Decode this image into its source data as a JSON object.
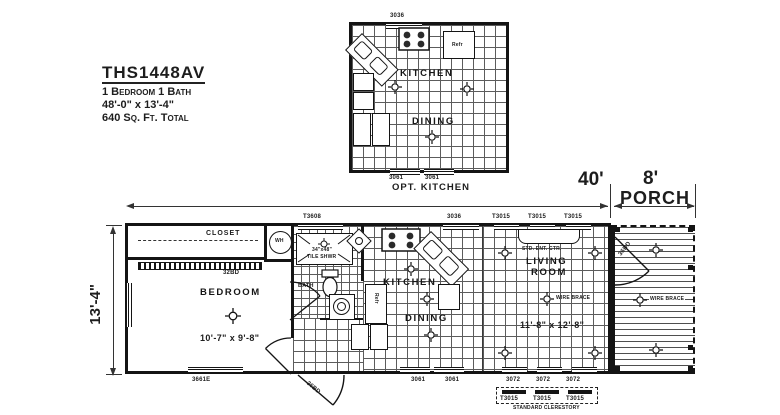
{
  "title_block": {
    "model": "THS1448AV",
    "beds_baths": "1 Bedroom 1 Bath",
    "size": "48'-0\" x 13'-4\"",
    "area": "640 Sq. Ft. Total"
  },
  "opt_kitchen": {
    "caption": "OPT. KITCHEN",
    "top_window": "3036",
    "bottom_windows": [
      "3061",
      "3061"
    ],
    "kitchen": "KITCHEN",
    "dining": "DINING",
    "refrigerator": "Refr"
  },
  "dims": {
    "main_width": "40'",
    "porch_width": "8'",
    "porch": "PORCH",
    "height": "13'-4\""
  },
  "top_windows": [
    "T3608",
    "3036",
    "T3015",
    "T3015",
    "T3015"
  ],
  "bottom_windows": {
    "bedroom": "3661E",
    "dining": [
      "3061",
      "3061"
    ]
  },
  "clerestory": {
    "windows": [
      "3072",
      "3072",
      "3072"
    ],
    "transoms": [
      "T3015",
      "T3015",
      "T3015"
    ],
    "caption": "STANDARD CLERESTORY"
  },
  "bedroom": {
    "label": "BEDROOM",
    "size": "10'-7\" x 9'-8\"",
    "closet": "CLOSET",
    "closet_door": "32BD",
    "water_heater": "WH"
  },
  "bath": {
    "label": "BATH",
    "shower_size": "34\"x48\"",
    "shower_type": "TILE SHWR"
  },
  "kitchen": {
    "label": "KITCHEN",
    "refrigerator": "Refr"
  },
  "dining": {
    "label": "DINING",
    "entry_door": "36BD"
  },
  "living": {
    "line1": "LIVING",
    "line2": "ROOM",
    "size": "11'-8\" x 12'-8\"",
    "ent_center": "STD. ENT. CTR.",
    "wire_brace": "WIRE BRACE",
    "porch_door": "36BD"
  },
  "porch": {
    "wire_brace": "WIRE BRACE"
  }
}
